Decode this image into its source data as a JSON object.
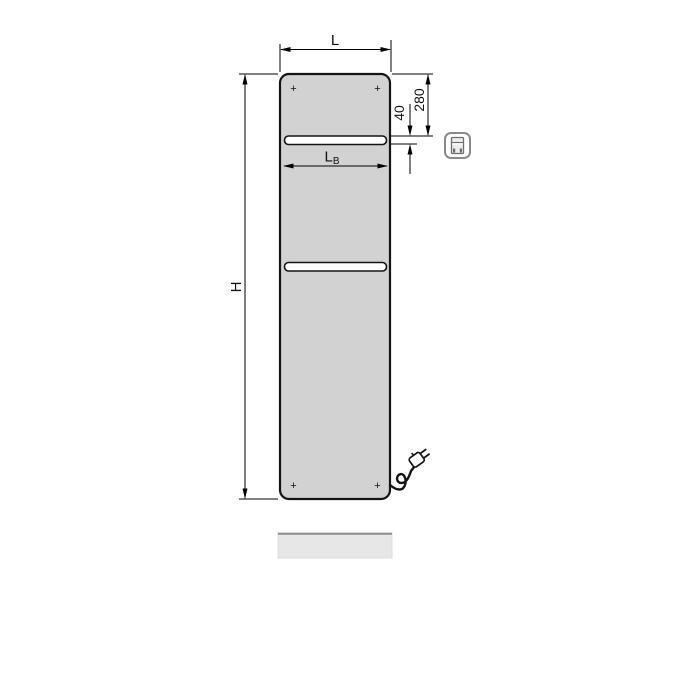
{
  "dimensions": {
    "overall_width_label": "L",
    "overall_height_label": "H",
    "rail_width_label_main": "L",
    "rail_width_label_sub": "B",
    "top_to_rail_label": "280",
    "rail_slot_height_label": "40"
  },
  "corner_marks": {
    "symbol": "+"
  },
  "icons": {
    "product_type": "panel-radiator-icon",
    "plug": "power-plug-icon"
  },
  "colors": {
    "background": "#ffffff",
    "panel_fill": "#d2d2d2",
    "panel_stroke": "#141414",
    "rail_fill": "#ffffff",
    "dimension_line": "#000000",
    "baseboard_fill": "#e7e7e7",
    "baseboard_top_edge": "#8f8f8f",
    "icon_stroke": "#8a8a8a"
  }
}
